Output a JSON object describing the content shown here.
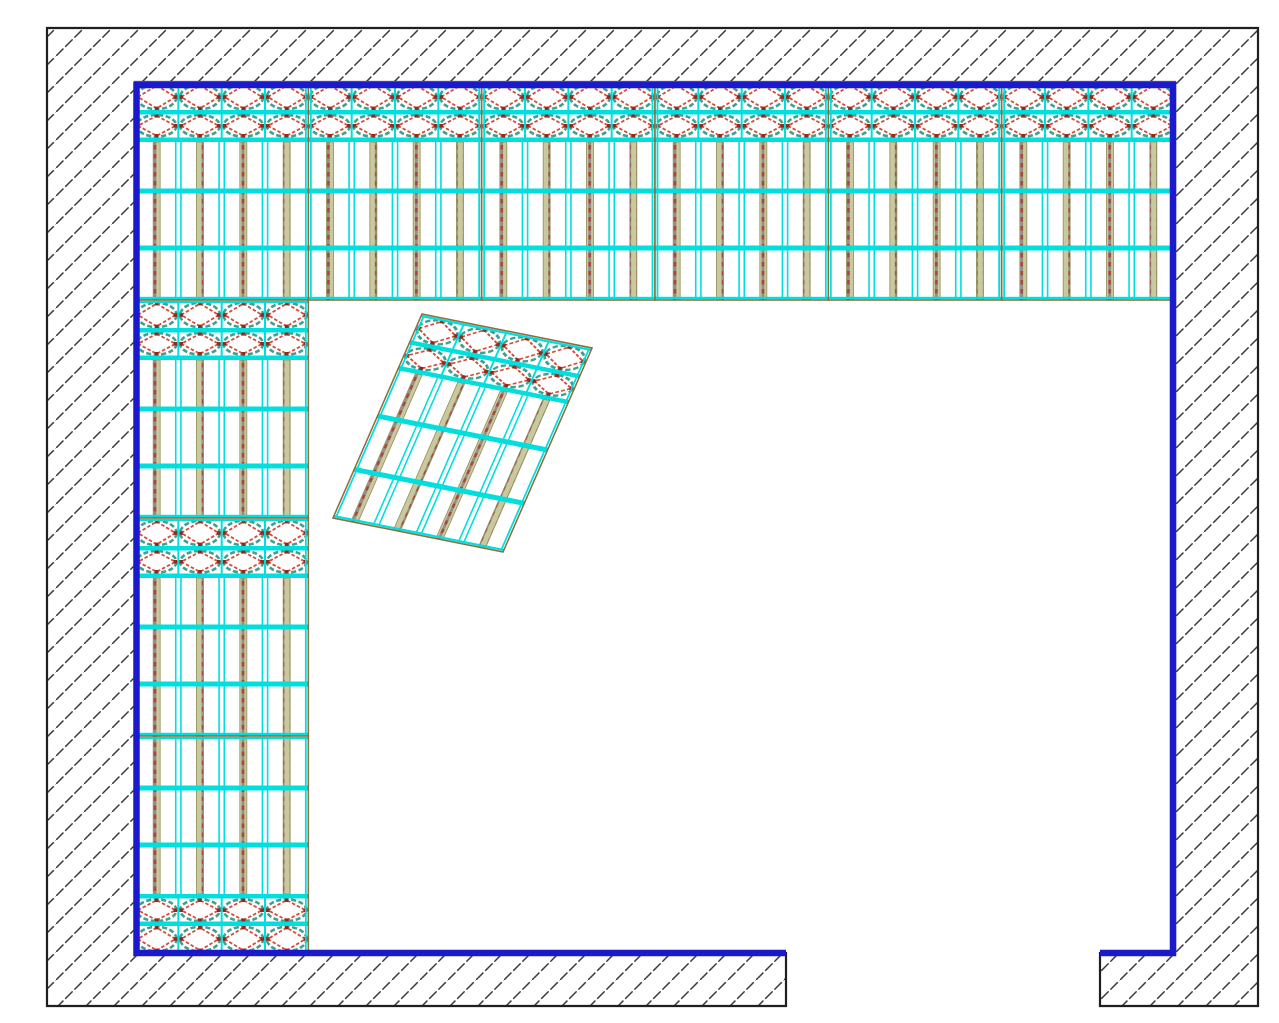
{
  "drawing": {
    "canvas": {
      "w": 1279,
      "h": 1023,
      "bg": "#ffffff"
    },
    "colors": {
      "cyan": "#00dede",
      "teal": "#3fa092",
      "diamond_red": "#d84b38",
      "diamond_tip_red": "#8e2b1f",
      "panel_border_olive": "#8a7040",
      "post_tan": "#c9c9a0",
      "post_red": "#a8463a",
      "post_gray": "#8f8f8f",
      "post_edge_olive": "#8f8f55",
      "wall_face_blue": "#1a1acc",
      "wall_outline_black": "#1f1f1f",
      "hatch_gray": "#3d3d3d",
      "white": "#ffffff"
    },
    "wall": {
      "outline_path": "M47,28 H1258 V1006 H1100 V953 H1175 V82 H135 V953 H786 V1006 H47 Z",
      "face_path": "M786,953 H136.5 V85 H1173 V953 H1100",
      "outline_width": 2.2,
      "face_width": 6.5,
      "hatch": {
        "tile": 28,
        "stroke_width": 1.5,
        "dash": "10.5 2.5"
      }
    },
    "panel_spec": {
      "w": 173.33,
      "h": 218,
      "cols": 4,
      "rx": 19.8,
      "diamond_rows": [
        {
          "cy": 15,
          "ry": 12.2,
          "top": 2,
          "bot": 28
        },
        {
          "cy": 43.8,
          "ry": 10.8,
          "top": 32.5,
          "bot": 55.5
        }
      ],
      "rails": [
        [
          1,
          2.2
        ],
        [
          28,
          4.5
        ],
        [
          55.5,
          4.5
        ],
        [
          106.5,
          5
        ],
        [
          163.5,
          5
        ],
        [
          214.8,
          2.2
        ]
      ],
      "vline_split": 60,
      "double_gap": 2.6,
      "post": {
        "w": 7,
        "top": 60
      },
      "diamond_dash": "3.5 2",
      "ellipse_dash": "5 2.5",
      "tip_size": 3.6
    },
    "panels": [
      {
        "x": 135,
        "y": 82
      },
      {
        "x": 308.33,
        "y": 82
      },
      {
        "x": 481.67,
        "y": 82
      },
      {
        "x": 655,
        "y": 82
      },
      {
        "x": 828.33,
        "y": 82
      },
      {
        "x": 1001.67,
        "y": 82
      },
      {
        "x": 135,
        "y": 300
      },
      {
        "x": 135,
        "y": 518
      },
      {
        "x": 135,
        "y": 736,
        "flip": true
      },
      {
        "matrix": [
          0.981,
          0.1962,
          -0.4083,
          0.9358,
          422,
          314
        ]
      }
    ]
  }
}
